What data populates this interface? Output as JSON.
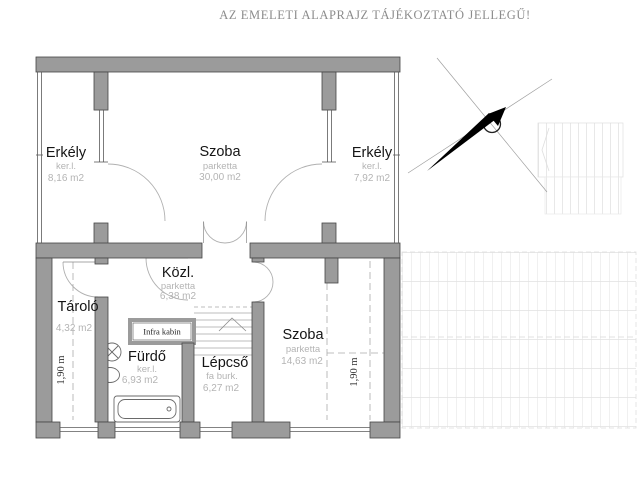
{
  "title": "AZ EMELETI ALAPRAJZ TÁJÉKOZTATÓ JELLEGŰ!",
  "rooms": {
    "erkely_left": {
      "name": "Erkély",
      "finish": "ker.l.",
      "area": "8,16 m2"
    },
    "szoba_top": {
      "name": "Szoba",
      "finish": "parketta",
      "area": "30,00 m2"
    },
    "erkely_right": {
      "name": "Erkély",
      "finish": "ker.l.",
      "area": "7,92 m2"
    },
    "kozl": {
      "name": "Közl.",
      "finish": "parketta",
      "area": "6,38 m2"
    },
    "tarolo": {
      "name": "Tároló",
      "area": "4,32 m2"
    },
    "furdo": {
      "name": "Fürdő",
      "finish": "ker.l.",
      "area": "6,93 m2"
    },
    "lepcso": {
      "name": "Lépcső",
      "finish": "fa burk.",
      "area": "6,27 m2"
    },
    "szoba_lower": {
      "name": "Szoba",
      "finish": "parketta",
      "area": "14,63 m2"
    },
    "infra_kabin": {
      "name": "Infra kabin"
    }
  },
  "dimensions": {
    "left_height": "1,90 m",
    "right_height": "1,90 m"
  },
  "colors": {
    "wall_fill": "#9b9b9b",
    "wall_outline": "#454545",
    "thin_line": "#5a5a5a",
    "label": "#151515",
    "muted_label": "#b4b4b4",
    "title": "#8c8c8c"
  }
}
